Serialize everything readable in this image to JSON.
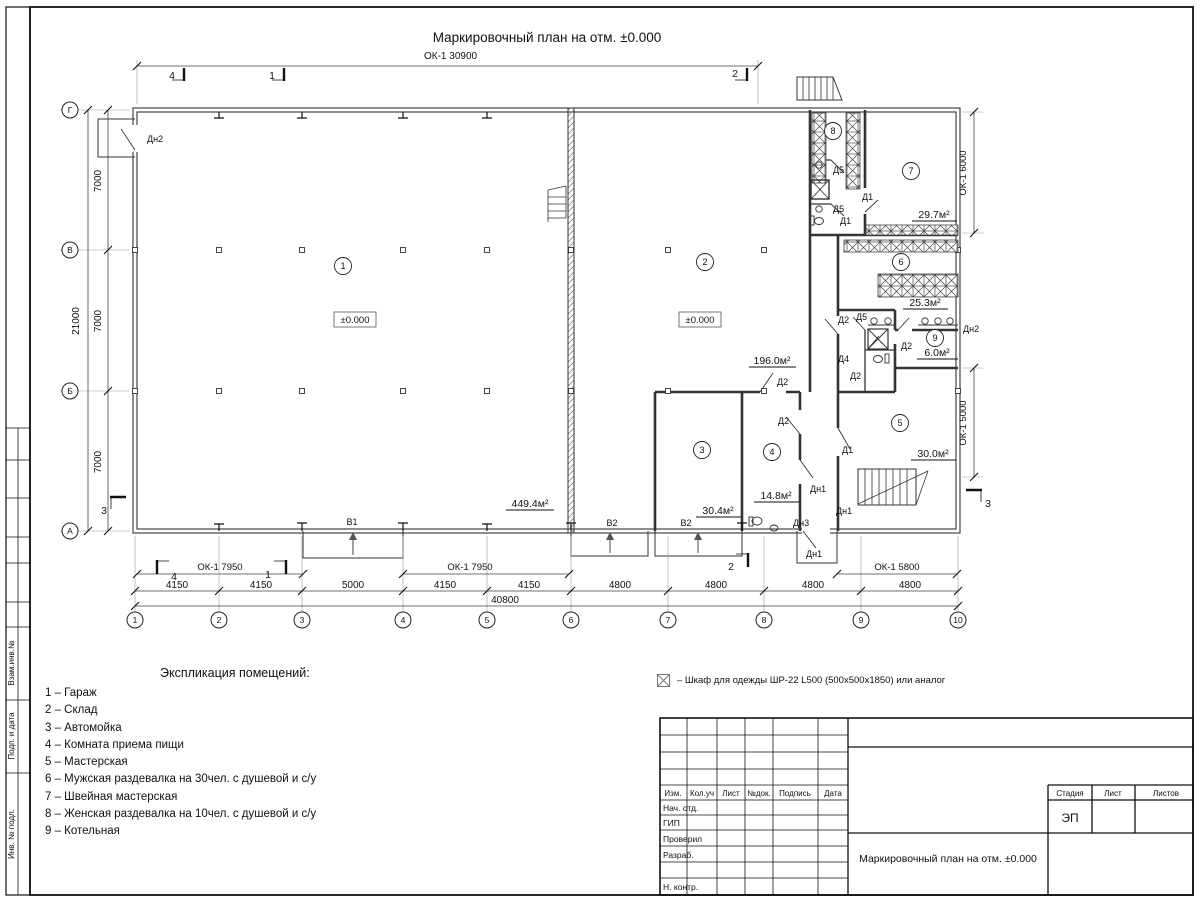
{
  "title": {
    "main": "Маркировочный план на отм. ±0.000"
  },
  "axes": {
    "cols": [
      "1",
      "2",
      "3",
      "4",
      "5",
      "6",
      "7",
      "8",
      "9",
      "10"
    ],
    "rows": [
      "Г",
      "В",
      "Б",
      "А"
    ]
  },
  "dims": {
    "top_window": "ОК-1 30900",
    "window_left": "ОК-1 7950",
    "window_mid": "ОК-1 7950",
    "window_right": "ОК-1 5800",
    "window_right_top": "ОК-1 6000",
    "window_right_bottom": "ОК-1 5000",
    "bottom_segments": [
      "4150",
      "4150",
      "5000",
      "4150",
      "4150",
      "4800",
      "4800",
      "4800",
      "4800"
    ],
    "bottom_total": "40800",
    "left_segments": [
      "7000",
      "7000",
      "7000"
    ],
    "left_total": "21000"
  },
  "sections": {
    "s1": "1",
    "s2": "2",
    "s3": "3",
    "s4": "4"
  },
  "rooms": {
    "r1": {
      "num": "1",
      "level": "±0.000",
      "area": "449.4м²"
    },
    "r2": {
      "num": "2",
      "level": "±0.000",
      "area": "196.0м²"
    },
    "r3": {
      "num": "3",
      "area": "30.4м²"
    },
    "r4": {
      "num": "4",
      "area": "14.8м²"
    },
    "r5": {
      "num": "5",
      "area": "30.0м²"
    },
    "r6": {
      "num": "6",
      "area": "25.3м²"
    },
    "r7": {
      "num": "7",
      "area": "29.7м²"
    },
    "r8": {
      "num": "8"
    },
    "r9": {
      "num": "9",
      "area": "6.0м²"
    }
  },
  "doors": {
    "d1": "Д1",
    "d2": "Д2",
    "d4": "Д4",
    "d5": "Д5",
    "dn1": "Дн1",
    "dn2": "Дн2",
    "dn3": "Дн3"
  },
  "gates": {
    "v1": "В1",
    "v2": "В2"
  },
  "legend": {
    "title": "Экспликация помещений:",
    "items": [
      "1 – Гараж",
      "2 – Склад",
      "3 – Автомойка",
      "4 – Комната приема пищи",
      "5 – Мастерская",
      "6 – Мужская раздевалка на 30чел. с душевой и с/у",
      "7 – Швейная мастерская",
      "8 – Женская раздевалка на 10чел. с душевой и с/у",
      "9 – Котельная"
    ]
  },
  "note": {
    "wardrobe": "– Шкаф для одежды ШР-22 L500 (500х500х1850) или аналог"
  },
  "titleblock": {
    "cols": [
      "Изм.",
      "Кол.уч",
      "Лист",
      "№док.",
      "Подпись",
      "Дата"
    ],
    "rows": [
      "Нач. отд.",
      "ГИП",
      "Проверил",
      "Разраб.",
      "Н. контр."
    ],
    "stage_label": "Стадия",
    "sheet_label": "Лист",
    "sheets_label": "Листов",
    "stage_value": "ЭП",
    "doc_title": "Маркировочный план на отм. ±0.000"
  },
  "frame": {
    "labels": [
      "Взам.инв.№",
      "Подп. и дата",
      "Инв. № подл."
    ]
  }
}
